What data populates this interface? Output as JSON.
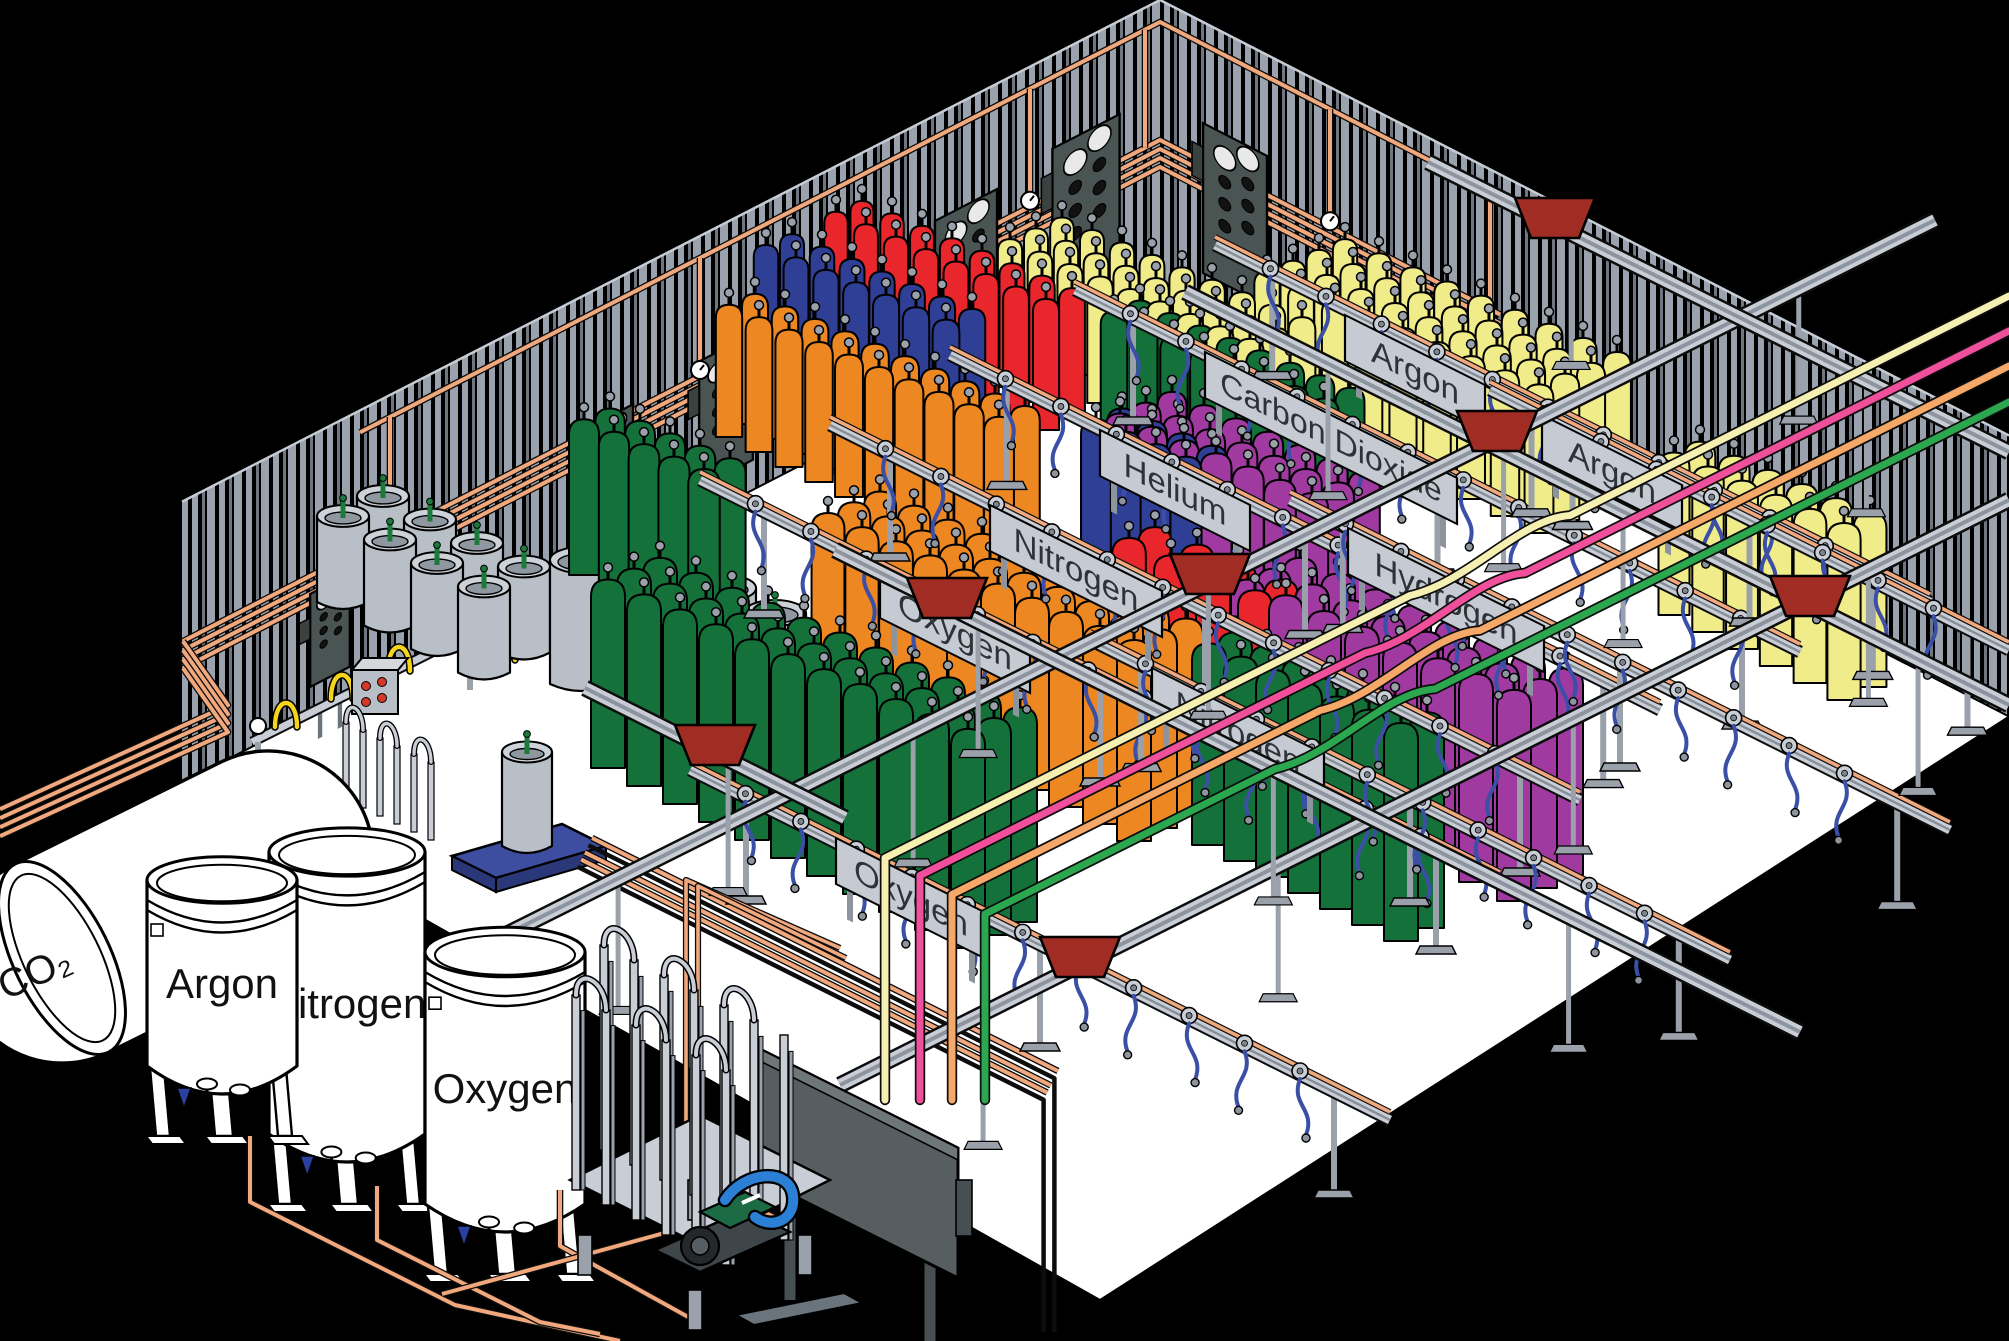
{
  "storage_tanks": {
    "co2": {
      "label": "CO₂"
    },
    "tanks": [
      {
        "label": "Nitrogen"
      },
      {
        "label": "Argon"
      },
      {
        "label": "Oxygen"
      }
    ]
  },
  "fill_stations": [
    {
      "label": "Oxygen",
      "cylinder_color": "green"
    },
    {
      "label": "Oxygen",
      "cylinder_color": "green"
    },
    {
      "label": "Nitrogen",
      "cylinder_color": "navy"
    },
    {
      "label": "Helium",
      "cylinder_color": "red"
    },
    {
      "label": "Carbon Dioxide",
      "cylinder_color": "yellow"
    },
    {
      "label": "Argon",
      "cylinder_color": "yellow"
    },
    {
      "label": "Hydrogen",
      "cylinder_color": "purple"
    },
    {
      "label": "Nitrogen",
      "cylinder_color": "navy"
    },
    {
      "label": "Argon",
      "cylinder_color": "yellow"
    }
  ],
  "colors": {
    "wall_stripe": "#99A2AD",
    "wall_stripe_dim": "#6E7682",
    "floor": "#FFFFFF",
    "outside": "#000000",
    "copper_pipe": "#F2A87D",
    "rail_light": "#C9CED6",
    "rail_mid": "#8D949E",
    "label_plate": "#C6CBD3",
    "label_text": "#2E3338",
    "hose_blue": "#3A4FA5",
    "pigtail_yellow": "#F5D41A",
    "trolley_red": "#A02C24",
    "manifold_panel": "#4A5553",
    "cylinder_green": "#15713A",
    "cylinder_orange": "#EC8722",
    "cylinder_navy": "#303F96",
    "cylinder_red": "#E8262C",
    "cylinder_yellow": "#F0EC8A",
    "cylinder_purple": "#A03AA0",
    "dewar_gray": "#B9BFC7",
    "pallet_blue": "#3D4DA0",
    "pump_green": "#1C6B45",
    "pump_hose_blue": "#2B7FD4",
    "supply_line_cream": "#F5F0B2",
    "supply_line_pink": "#F0509B",
    "supply_line_orange": "#F5A868",
    "supply_line_green": "#2BA84F"
  }
}
